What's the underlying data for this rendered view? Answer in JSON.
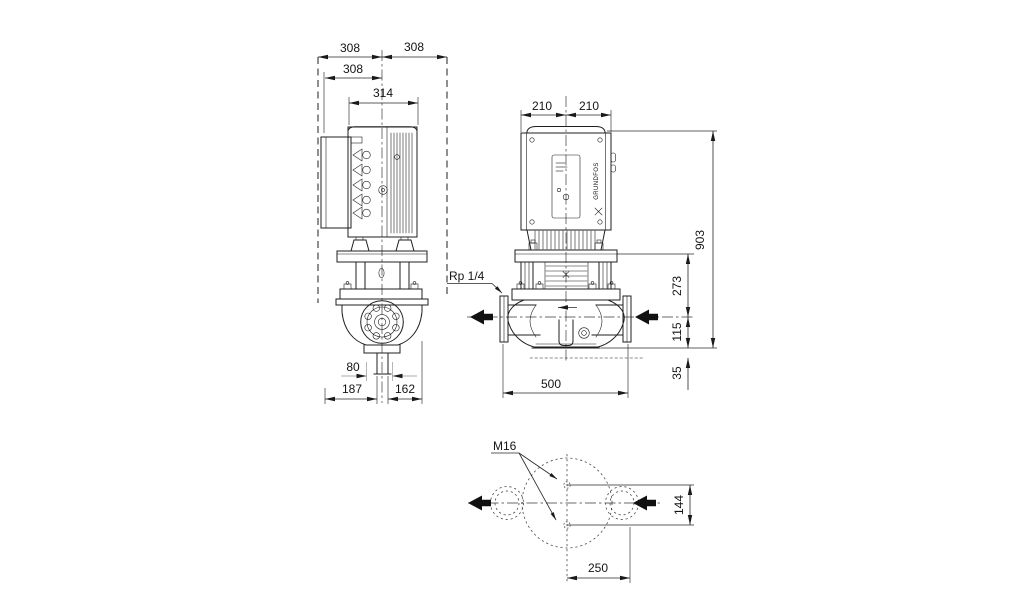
{
  "drawing": {
    "type": "pump dimensional outline drawing",
    "brand": "GRUNDFOS",
    "side_view": {
      "dim_swing_left": "308",
      "dim_swing_right": "308",
      "dim_box_to_center": "308",
      "dim_motor_width": "314",
      "dim_drain_bore": "80",
      "dim_center_to_left": "187",
      "dim_center_to_right": "162"
    },
    "front_view": {
      "dim_width_left": "210",
      "dim_width_right": "210",
      "label_gauge_port": "Rp 1/4",
      "dim_overall_height": "903",
      "dim_port_center_to_stool": "273",
      "dim_port_center_to_base": "115",
      "dim_base_thickness": "35",
      "dim_flange_to_flange": "500"
    },
    "bottom_view": {
      "label_foundation_bolts": "M16",
      "dim_bolt_pitch": "144",
      "dim_center_to_flange_face": "250"
    }
  }
}
